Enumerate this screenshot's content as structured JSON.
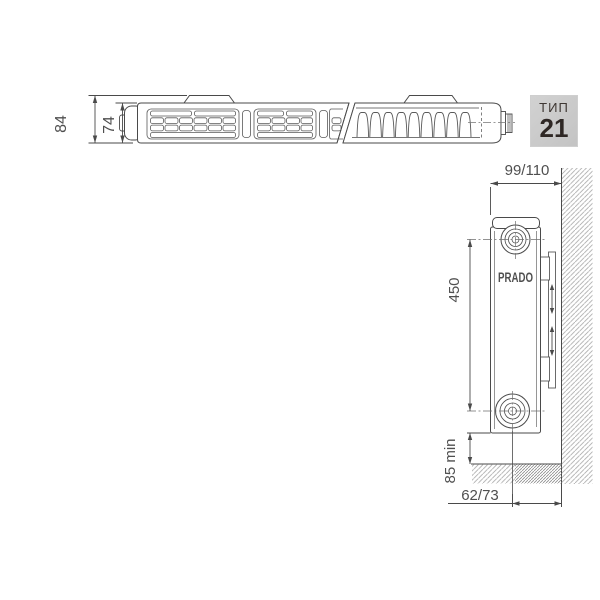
{
  "badge": {
    "label": "ТИП",
    "value": "21"
  },
  "brand": "PRADO",
  "top_view": {
    "dim_total_depth": "84",
    "dim_panel_depth": "74"
  },
  "side_view": {
    "dim_depth_from_wall": "99/110",
    "dim_connection_spacing": "450",
    "dim_floor_clearance": "85 min",
    "dim_pipe_to_wall": "62/73"
  },
  "colors": {
    "line": "#4a4a4a",
    "dim_text": "#4f4f4f",
    "hatch_light": "#a8a8a8",
    "hatch_dense": "#8d8d8d",
    "badge_bg": "#c9c9c9",
    "badge_text": "#352e2a"
  }
}
